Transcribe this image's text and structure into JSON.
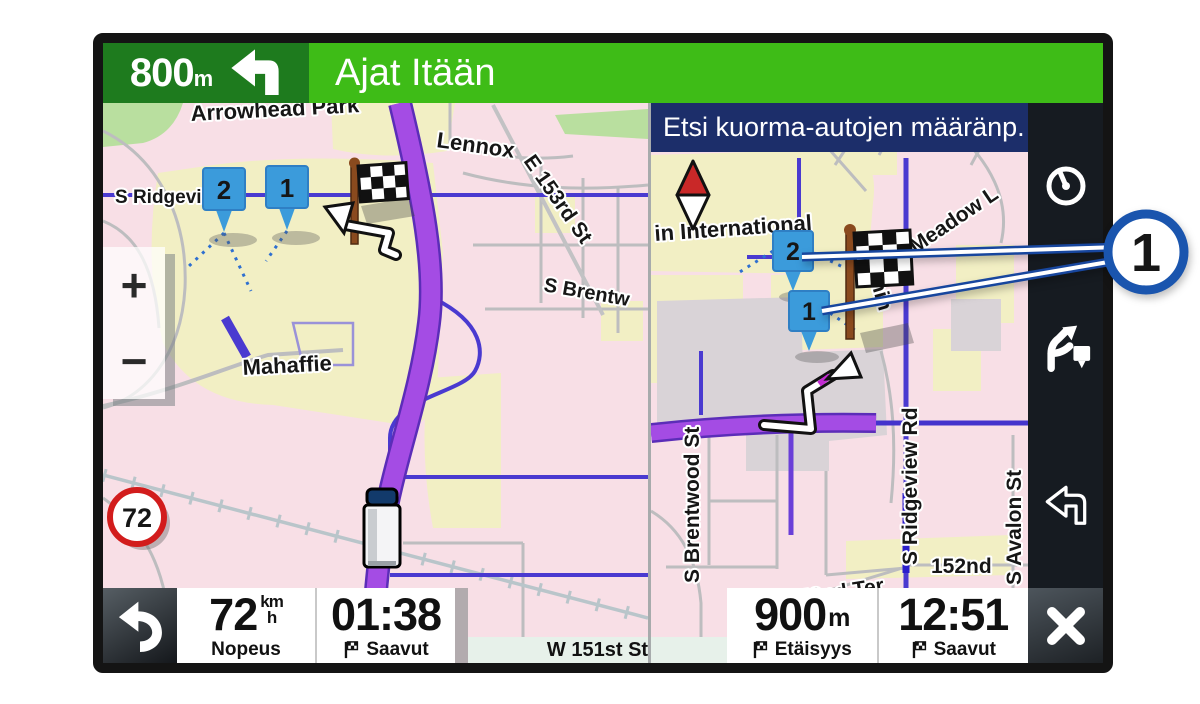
{
  "top_bar": {
    "distance_value": "800",
    "distance_unit": "m",
    "instruction": "Ajat Itään",
    "icon": "turn-left-arrow"
  },
  "left_map": {
    "labels": {
      "arrowhead_park": "Arrowhead Park",
      "lennox": "Lennox",
      "e_153rd": "E 153rd St",
      "s_ridgeview": "S Ridgeview",
      "s_brentwood": "S Brentw",
      "mahaffie": "Mahaffie"
    },
    "markers": {
      "m1": "1",
      "m2": "2"
    },
    "speed_limit": "72",
    "zoom_in": "+",
    "zoom_out": "−",
    "icons": [
      "checkered-flag",
      "route-arrow",
      "truck-vehicle"
    ]
  },
  "right_map": {
    "header": "Etsi kuorma-autojen määränp.",
    "labels": {
      "in_international": "in International",
      "e_meadow": "E Meadow L",
      "garmin": "Garmin",
      "s_ridgeview_rd": "S Ridgeview Rd",
      "s_brentwood_st": "S Brentwood St",
      "s_avalon_st": "S Avalon St",
      "street_152nd": "152nd",
      "w_152nd_ter": "W 152nd Ter"
    },
    "markers": {
      "m1": "1",
      "m2": "2"
    },
    "icons": [
      "compass-needle",
      "checkered-flag",
      "route-arrow"
    ]
  },
  "sidebar": {
    "icons": [
      "speedometer-icon",
      "road-branch-flag-icon",
      "hook-back-arrow-icon",
      "close-icon"
    ]
  },
  "callout": {
    "label": "1"
  },
  "bottom_bar": {
    "speed": {
      "value": "72",
      "unit_top": "km",
      "unit_bottom": "h",
      "label": "Nopeus"
    },
    "eta": {
      "value": "01:38",
      "label": "Saavut"
    },
    "street": "W 151st St",
    "distance": {
      "value": "900",
      "unit": "m",
      "label": "Etäisyys"
    },
    "arrival": {
      "value": "12:51",
      "label": "Saavut"
    }
  },
  "colors": {
    "accent_green_dark": "#1e7b1e",
    "accent_green": "#3ebc17",
    "header_navy": "#1c2e6a",
    "marker_blue": "#3b9bdb",
    "callout_blue": "#1a55ae",
    "route_purple": "#a44ce4",
    "road_blue": "#4a3ad0",
    "speed_limit_red": "#d21c1c",
    "map_pink": "#f8dfe6",
    "map_yellow": "#f2efc4",
    "sidebar_dark": "#161b21"
  }
}
